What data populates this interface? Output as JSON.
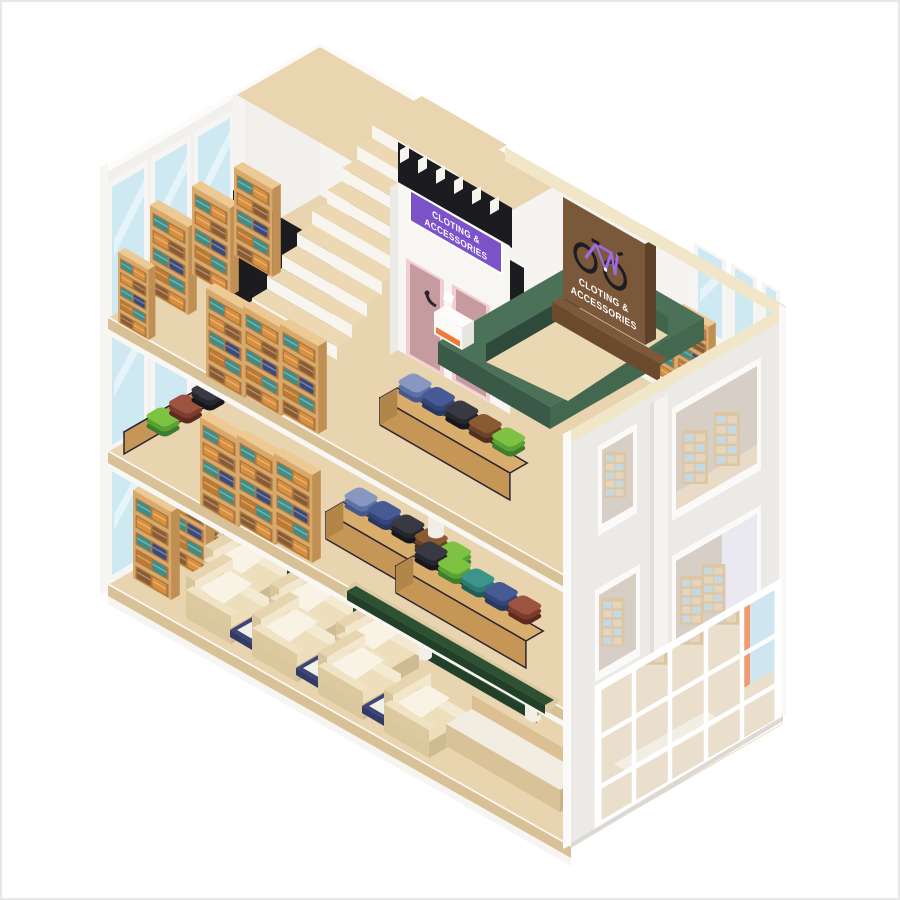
{
  "scene": {
    "type": "isometric-illustration",
    "subject": "Three-story clothing and accessories store cutaway",
    "signs": {
      "storefront": {
        "line1": "CLOTING &",
        "line2": "ACCESSORIES"
      },
      "billboard": {
        "line1": "CLOTING &",
        "line2": "ACCESSORIES",
        "icon": "bicycle-icon"
      }
    },
    "palette": {
      "background": "#ffffff",
      "frame_border": "#e7e7e7",
      "wall_left": "#f2f0ed",
      "wall_right": "#f6f4f1",
      "facade": "#eceae7",
      "roof_trim": "#f2e6c9",
      "floor_top": "#e8d4ae",
      "floor_edge": "#d8c197",
      "stairwell_black": "#1c1b1f",
      "stair_tread": "#ecd9b3",
      "sign_purple": "#7c52c9",
      "sign_brown": "#7c583a",
      "bicycle_purple": "#9c6ce0",
      "door_mauve": "#c69ba0",
      "door_frame_pink": "#f2ced3",
      "counter_green": "#4b7158",
      "shelf_wood": "#d9a96b",
      "hedge_green": "#2c5233",
      "armchair_cream": "#eddebc",
      "coffee_table_navy": "#3b4576",
      "glass_blue": "#cfe9f2"
    }
  }
}
